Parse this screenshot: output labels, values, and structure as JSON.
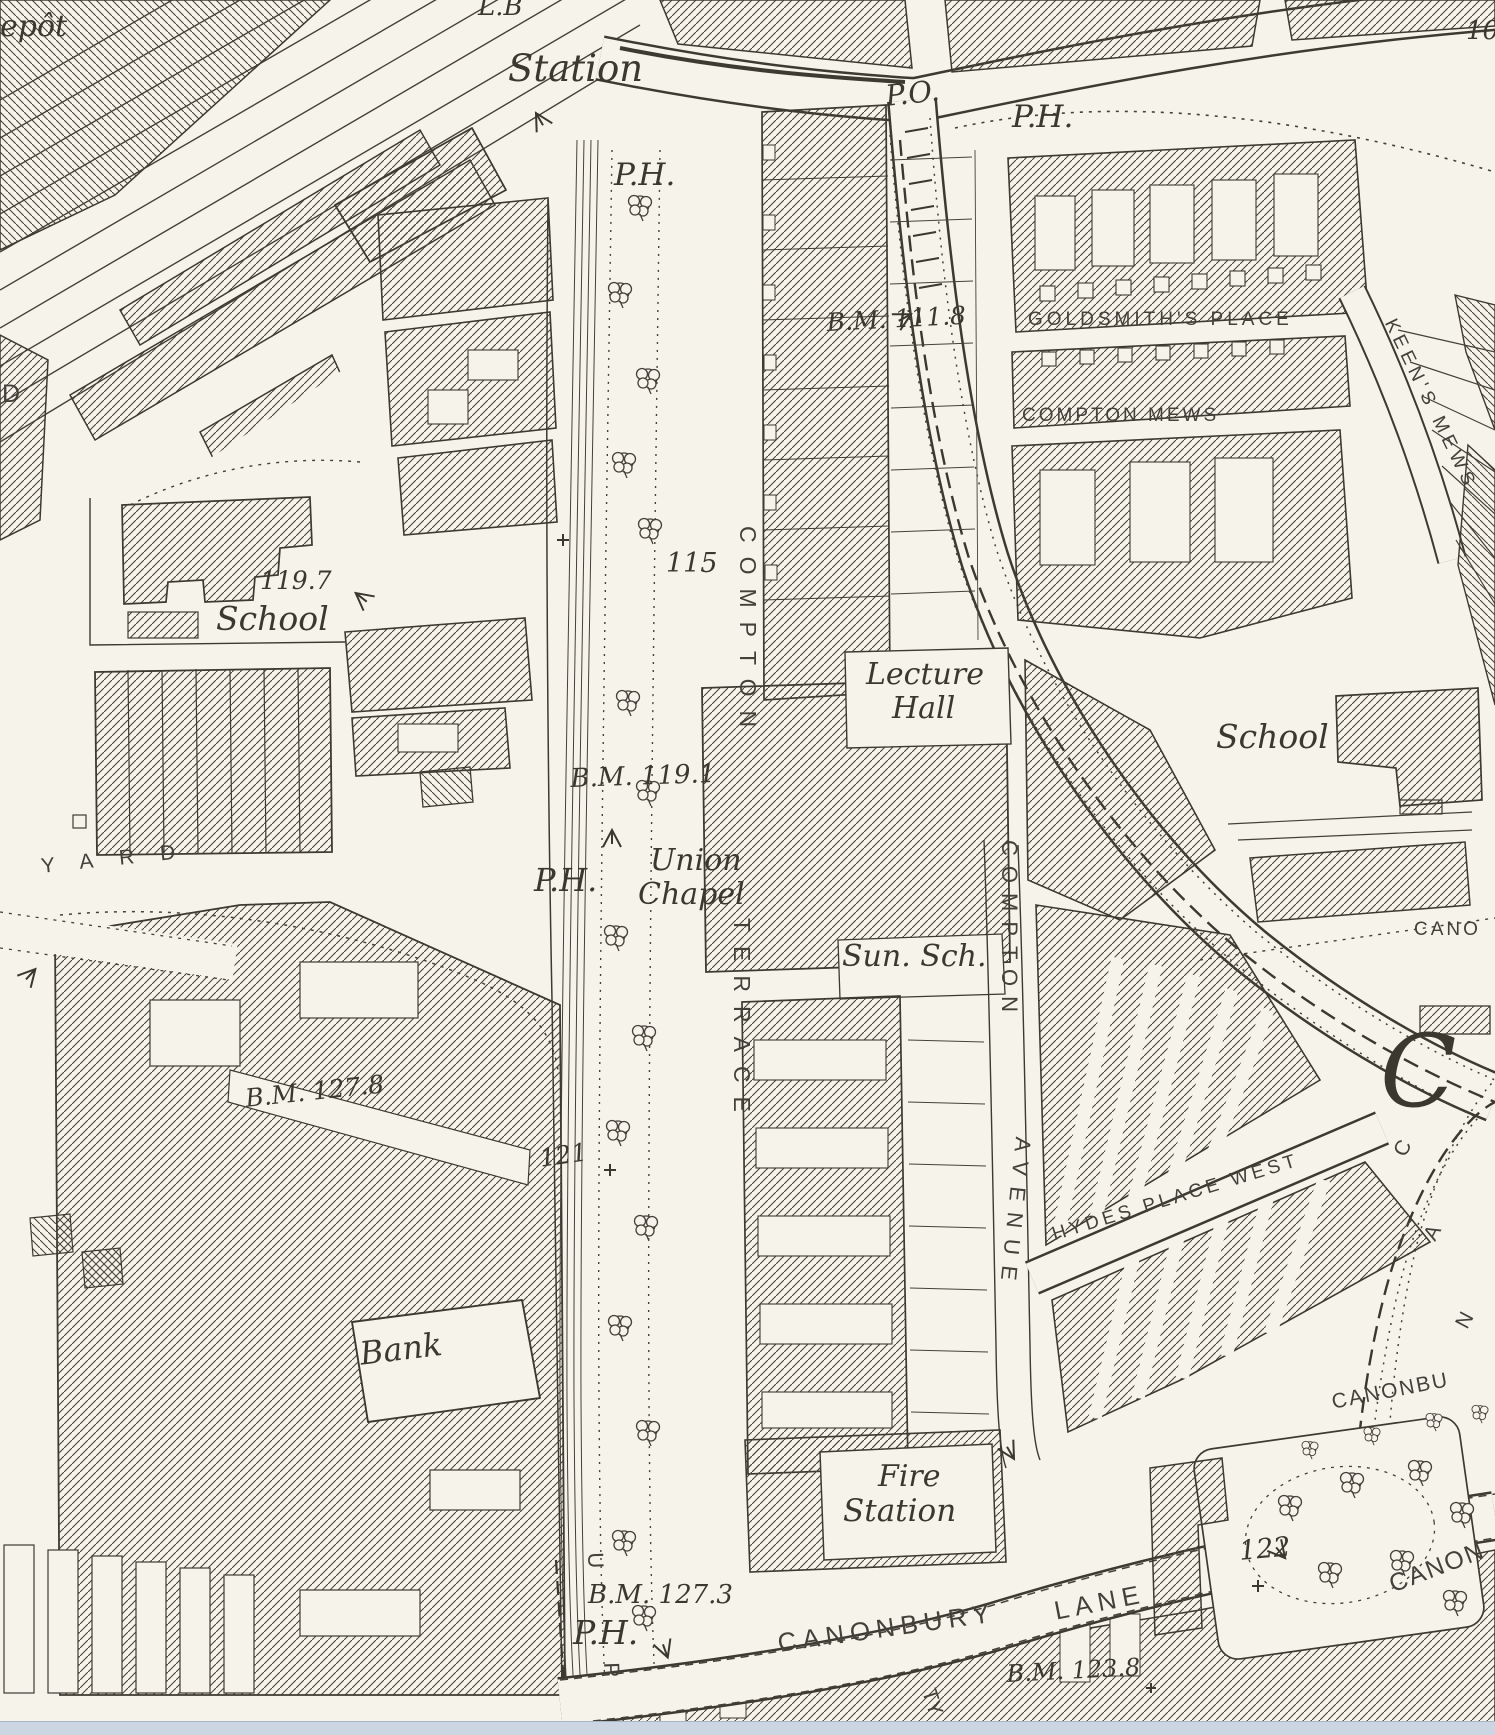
{
  "map": {
    "title": "Historical Ordnance Survey town plan — Compton Terrace / Canonbury",
    "paper_color": "#f6f3ea",
    "ink_color": "#3b382f",
    "scrollbar_color": "#ccd6e2",
    "labels": {
      "depot_partial": "epôt",
      "lb": "L.B",
      "station": "Station",
      "ph_station": "P.H.",
      "post_office": "P.O.",
      "ph_top_right": "P.H.",
      "bm_111_8": "B.M. 111.8",
      "goldsmiths_place": "GOLDSMITH'S PLACE",
      "compton_mews": "COMPTON MEWS",
      "keens_mews": "KEEN'S MEWS",
      "plot_10": "10",
      "spot_119_7": "119.7",
      "school_west": "School",
      "plot_115": "115",
      "compton_terrace_compton": "COMPTON",
      "compton_terrace_terrace": "TERRACE",
      "bm_119_1": "B.M. 119.1",
      "union": "Union",
      "chapel": "Chapel",
      "ph_union_chapel": "P.H.",
      "lecture": "Lecture",
      "hall": "Hall",
      "sunday_school": "Sun. Sch.",
      "compton_avenue_compton": "COMPTON",
      "compton_avenue_avenue": "AVENUE",
      "school_east": "School",
      "cano_partial": "CANO",
      "bm_127_8": "B.M. 127.8",
      "spot_121": "121",
      "bank": "Bank",
      "hydes_place_west": "HYDES PLACE WEST",
      "canonbury_initial": "C",
      "can_c": "C",
      "can_a": "A",
      "can_n": "N",
      "canonbu_partial": "CANONBU",
      "spot_122": "122",
      "canon_partial": "CANON",
      "fire": "Fire",
      "fire_station_station": "Station",
      "bm_127_3": "B.M. 127.3",
      "ph_canonbury": "P.H.",
      "upper_street_u": "U",
      "upper_street_p": "P",
      "canonbury": "CANONBURY",
      "lane": "LANE",
      "bm_123_8": "B.M. 123.8",
      "tyn_partial": "TY",
      "road_d_partial": "D",
      "yard": "YARD"
    }
  }
}
